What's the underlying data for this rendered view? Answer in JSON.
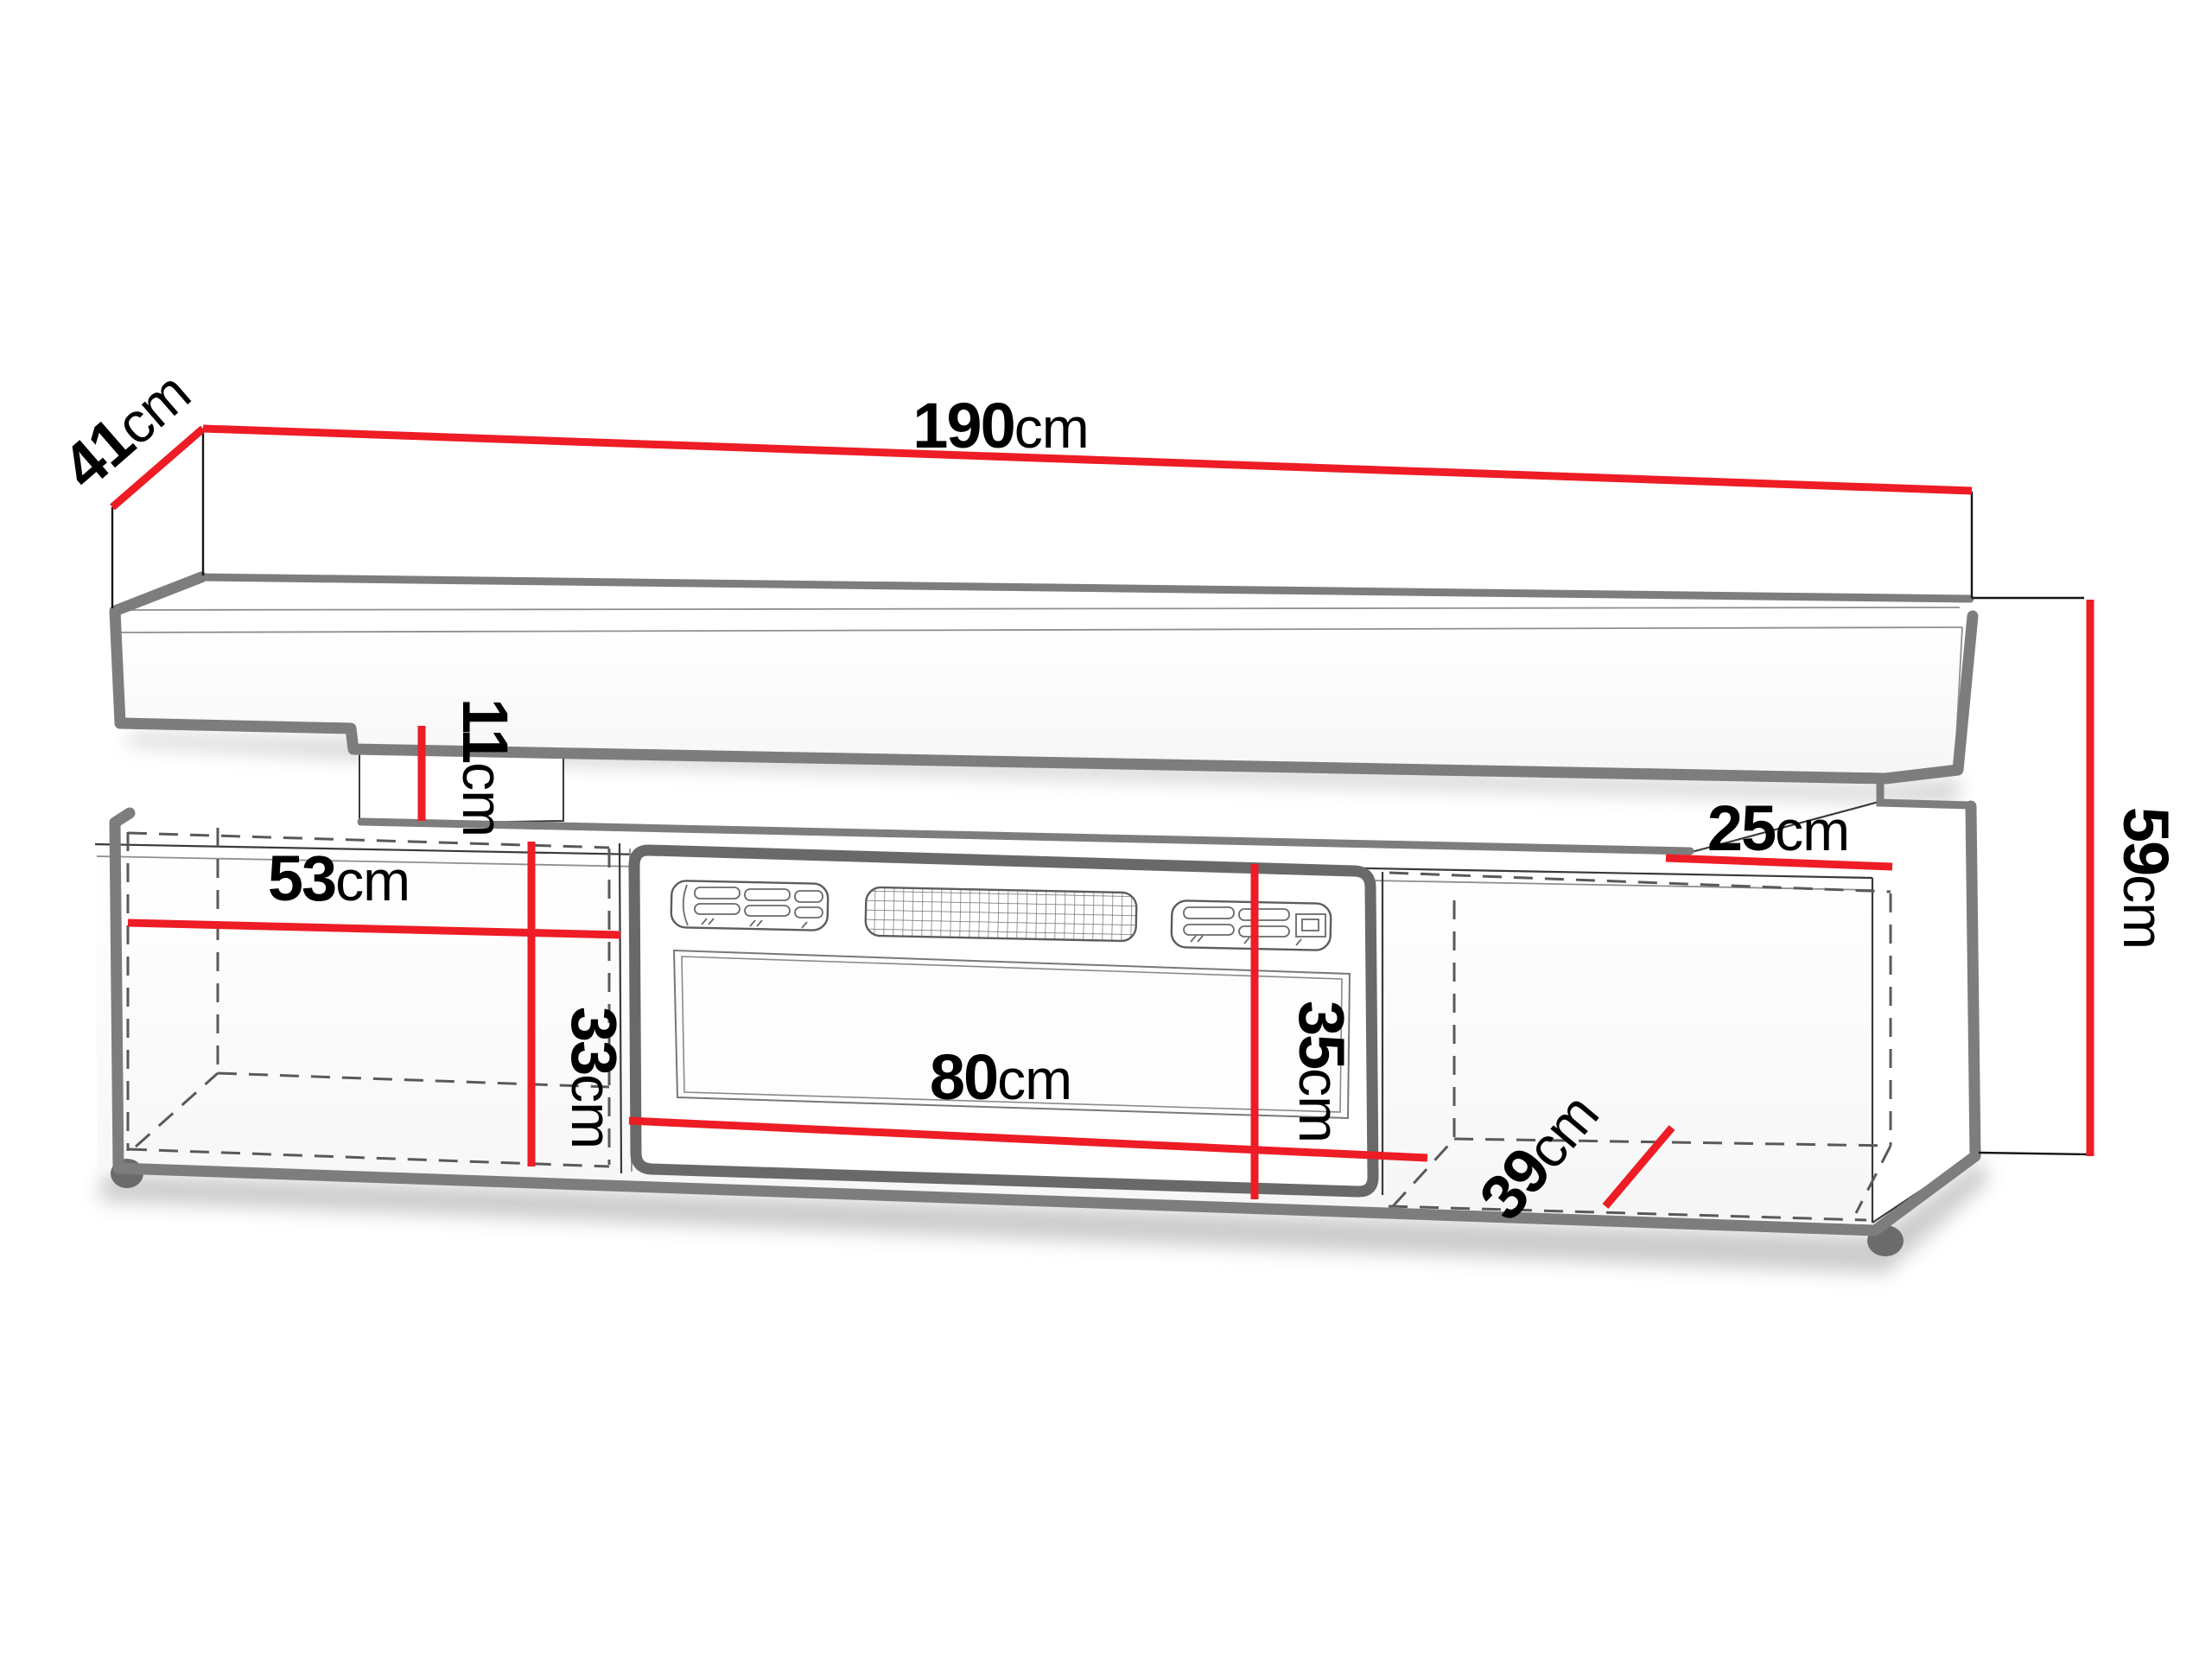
{
  "diagram": {
    "type": "furniture-dimension-diagram",
    "subject": "TV stand with electric fireplace insert and floating wall shelf",
    "unit": "cm",
    "colors": {
      "dimension_line": "#ee1c25",
      "outline_thick": "#7d7d7d",
      "outline_thin": "#3a3a3a",
      "dashed_line": "#595959",
      "insert_frame": "#696969",
      "background": "#ffffff"
    },
    "dimensions": {
      "shelf_width": {
        "value": "190",
        "unit": "cm"
      },
      "shelf_depth": {
        "value": "41",
        "unit": "cm"
      },
      "gap_height": {
        "value": "11",
        "unit": "cm"
      },
      "left_section_width": {
        "value": "53",
        "unit": "cm"
      },
      "left_section_height": {
        "value": "33",
        "unit": "cm"
      },
      "fireplace_width": {
        "value": "80",
        "unit": "cm"
      },
      "fireplace_height": {
        "value": "35",
        "unit": "cm"
      },
      "right_top_depth": {
        "value": "25",
        "unit": "cm"
      },
      "cabinet_height": {
        "value": "59",
        "unit": "cm"
      },
      "cabinet_depth": {
        "value": "39",
        "unit": "cm"
      }
    }
  }
}
